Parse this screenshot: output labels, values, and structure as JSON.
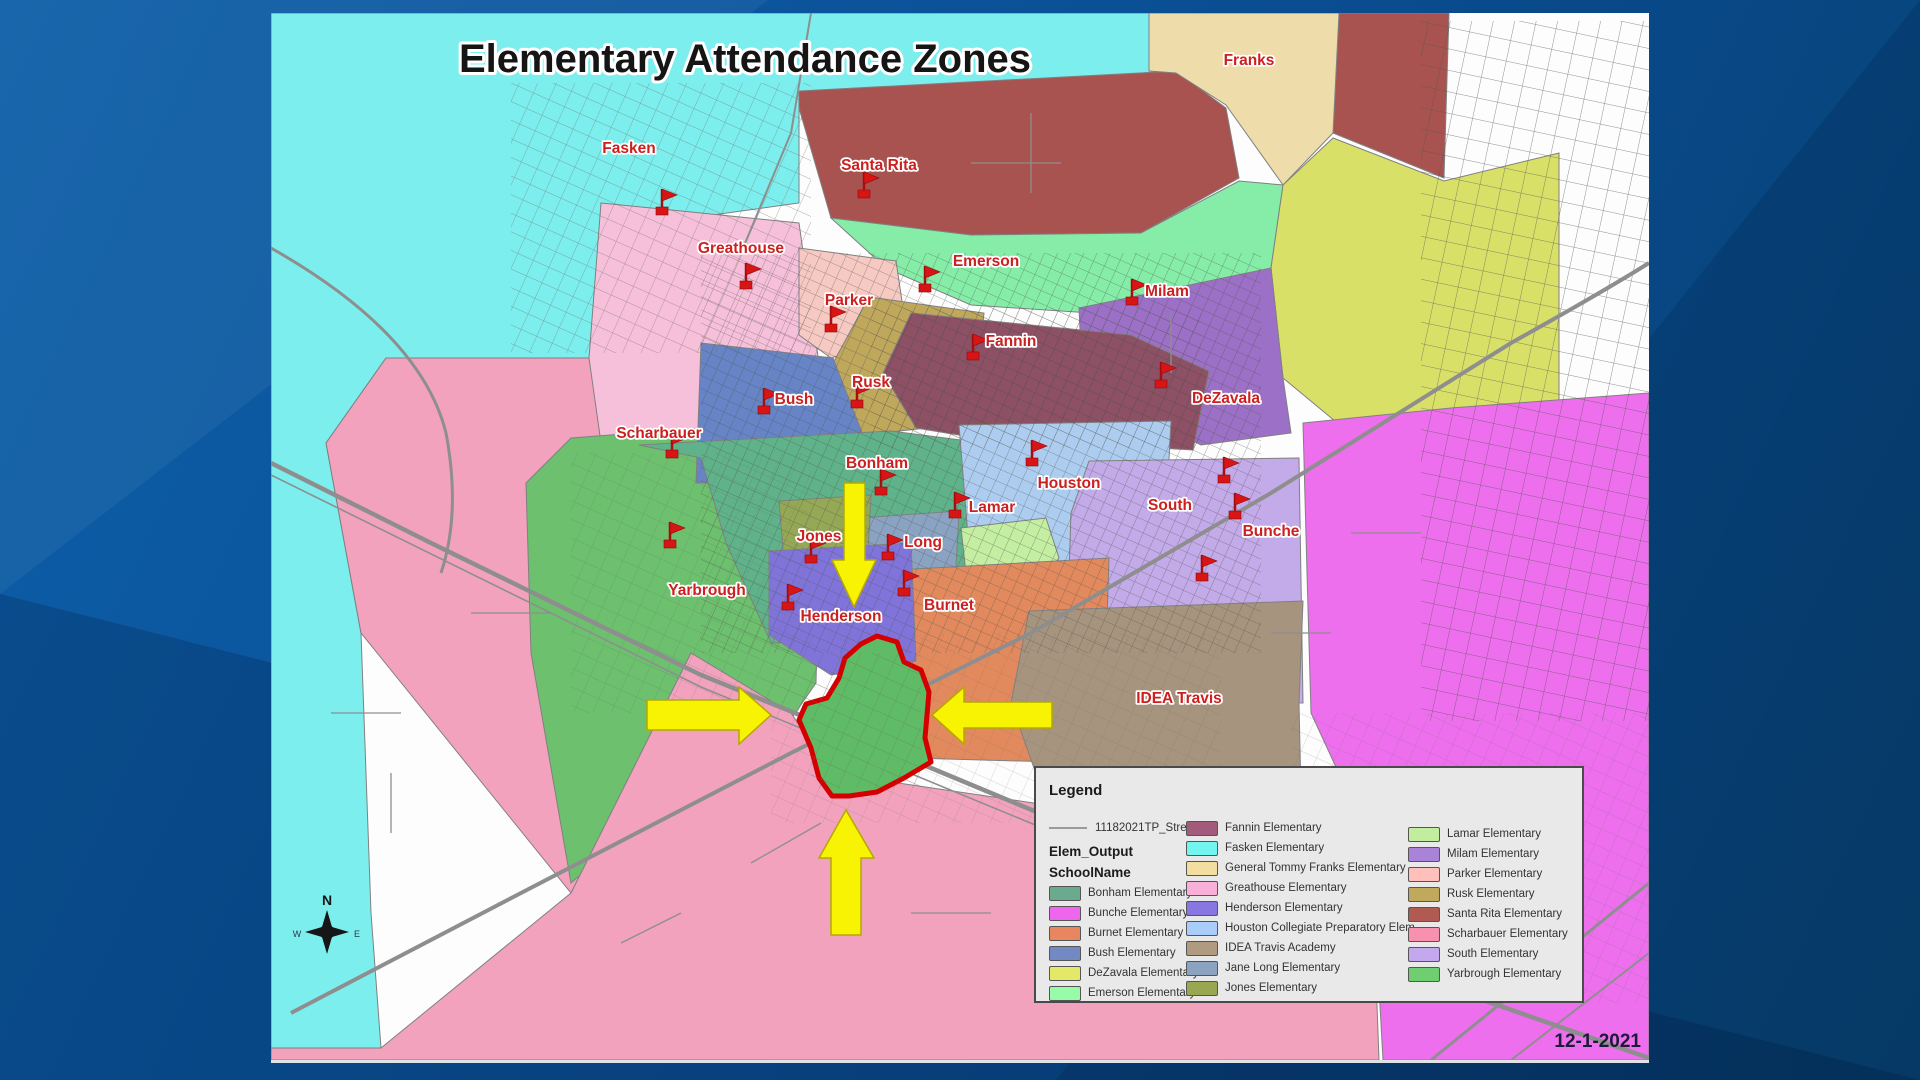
{
  "title": "Elementary Attendance Zones",
  "date_label": "12-1-2021",
  "label_red": "#cc1f1f",
  "flag_red": "#d81414",
  "compass": {
    "north": "N",
    "west": "W",
    "east": "E"
  },
  "legend": {
    "title": "Legend",
    "street_symbol_label": "11182021TP_Street",
    "layer_label": "Elem_Output",
    "field_label": "SchoolName",
    "columns": [
      [
        {
          "label": "Bonham Elementary",
          "color": "#6aab8f"
        },
        {
          "label": "Bunche Elementary",
          "color": "#ee66ee"
        },
        {
          "label": "Burnet Elementary",
          "color": "#e8875f"
        },
        {
          "label": "Bush Elementary",
          "color": "#7289c4"
        },
        {
          "label": "DeZavala Elementary",
          "color": "#e3e869"
        },
        {
          "label": "Emerson Elementary",
          "color": "#98fba8"
        }
      ],
      [
        {
          "label": "Fannin Elementary",
          "color": "#a25b7a"
        },
        {
          "label": "Fasken Elementary",
          "color": "#72f5ef"
        },
        {
          "label": "General Tommy Franks Elementary",
          "color": "#f2dfa0"
        },
        {
          "label": "Greathouse Elementary",
          "color": "#f8b0d8"
        },
        {
          "label": "Henderson Elementary",
          "color": "#8877e0"
        },
        {
          "label": "Houston Collegiate Preparatory Elem",
          "color": "#aaccf8"
        },
        {
          "label": "IDEA Travis Academy",
          "color": "#b09a80"
        },
        {
          "label": "Jane Long Elementary",
          "color": "#8ba3c0"
        },
        {
          "label": "Jones Elementary",
          "color": "#99a752"
        }
      ],
      [
        {
          "label": "Lamar Elementary",
          "color": "#c2ec9e"
        },
        {
          "label": "Milam Elementary",
          "color": "#a883d8"
        },
        {
          "label": "Parker Elementary",
          "color": "#ffc0bb"
        },
        {
          "label": "Rusk Elementary",
          "color": "#c0a85c"
        },
        {
          "label": "Santa Rita Elementary",
          "color": "#b05a52"
        },
        {
          "label": "Scharbauer Elementary",
          "color": "#f890b0"
        },
        {
          "label": "South Elementary",
          "color": "#c4a8ee"
        },
        {
          "label": "Yarbrough Elementary",
          "color": "#6fce6f"
        }
      ]
    ]
  },
  "schools": [
    {
      "name": "Fasken",
      "x": 358,
      "y": 140,
      "fx": 391,
      "fy": 196
    },
    {
      "name": "Santa Rita",
      "x": 608,
      "y": 157,
      "fx": 593,
      "fy": 179
    },
    {
      "name": "Greathouse",
      "x": 470,
      "y": 240,
      "fx": 475,
      "fy": 270
    },
    {
      "name": "Emerson",
      "x": 715,
      "y": 253,
      "fx": 654,
      "fy": 273
    },
    {
      "name": "Parker",
      "x": 578,
      "y": 292,
      "fx": 560,
      "fy": 313
    },
    {
      "name": "Milam",
      "x": 896,
      "y": 283,
      "fx": 861,
      "fy": 286
    },
    {
      "name": "Fannin",
      "x": 740,
      "y": 333,
      "fx": 702,
      "fy": 341
    },
    {
      "name": "Bush",
      "x": 523,
      "y": 391,
      "fx": 493,
      "fy": 395
    },
    {
      "name": "Rusk",
      "x": 600,
      "y": 374,
      "fx": 586,
      "fy": 389
    },
    {
      "name": "DeZavala",
      "x": 955,
      "y": 390,
      "fx": 890,
      "fy": 369
    },
    {
      "name": "Scharbauer",
      "x": 388,
      "y": 425,
      "fx": 401,
      "fy": 439
    },
    {
      "name": "Bonham",
      "x": 606,
      "y": 455,
      "fx": 610,
      "fy": 476
    },
    {
      "name": "Houston",
      "x": 798,
      "y": 475,
      "fx": 761,
      "fy": 447
    },
    {
      "name": "Lamar",
      "x": 721,
      "y": 499,
      "fx": 684,
      "fy": 499
    },
    {
      "name": "South",
      "x": 899,
      "y": 497,
      "fx": 964,
      "fy": 500
    },
    {
      "name": "Jones",
      "x": 548,
      "y": 528,
      "fx": 540,
      "fy": 544
    },
    {
      "name": "Long",
      "x": 652,
      "y": 534,
      "fx": 617,
      "fy": 541
    },
    {
      "name": "Bunche",
      "x": 1000,
      "y": 523,
      "fx": 953,
      "fy": 464
    },
    {
      "name": "Yarbrough",
      "x": 436,
      "y": 582,
      "fx": 399,
      "fy": 529
    },
    {
      "name": "Henderson",
      "x": 570,
      "y": 608,
      "fx": 517,
      "fy": 591
    },
    {
      "name": "Burnet",
      "x": 678,
      "y": 597,
      "fx": 633,
      "fy": 577
    },
    {
      "name": "IDEA Travis",
      "x": 908,
      "y": 690,
      "fx": 931,
      "fy": 562
    },
    {
      "name": "Franks",
      "x": 978,
      "y": 52,
      "fx": null,
      "fy": null
    }
  ],
  "zone_colors": {
    "fasken": "#7deeee",
    "scharbauer": "#f2a2bd",
    "greathouse": "#f7c0da",
    "santa_rita": "#a85350",
    "franks": "#eedcaa",
    "emerson": "#85eda8",
    "dezavala": "#d9e068",
    "milam": "#9b70c6",
    "parker": "#f6c9c2",
    "rusk": "#bfa75c",
    "bush": "#6684c6",
    "fannin": "#8d5065",
    "bonham": "#5fb28a",
    "houston": "#adcdf0",
    "lamar": "#c4eea2",
    "long": "#8ba3c2",
    "jones": "#95a855",
    "south": "#c3aae9",
    "bunche": "#ee6fee",
    "idea_travis": "#a6947e",
    "burnet": "#e28a5e",
    "henderson": "#8074da",
    "yarbrough": "#6cc06e",
    "highlight_fill": "#5fbb66",
    "highlight_outline": "#d40000",
    "arrow": "#f8f303",
    "arrow_edge": "#b3a900",
    "road": "#8e8e8e"
  }
}
